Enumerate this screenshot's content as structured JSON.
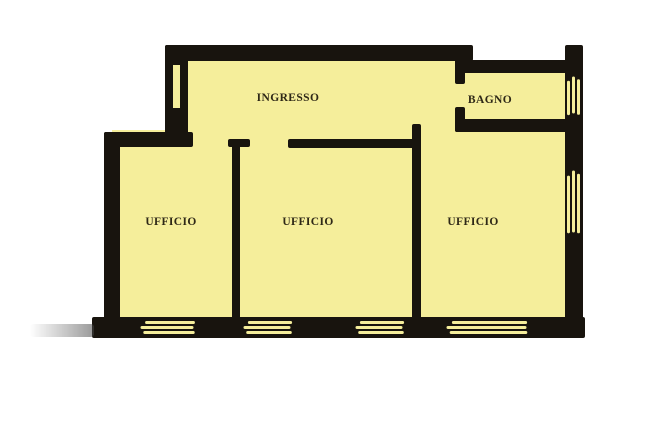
{
  "plan": {
    "rooms": [
      {
        "id": "ingresso",
        "label": "INGRESSO"
      },
      {
        "id": "bagno",
        "label": "BAGNO"
      },
      {
        "id": "ufficio-left",
        "label": "UFFICIO"
      },
      {
        "id": "ufficio-center",
        "label": "UFFICIO"
      },
      {
        "id": "ufficio-right",
        "label": "UFFICIO"
      }
    ],
    "colors": {
      "room_fill": "#f5ee9b",
      "wall": "#18140e",
      "label_text": "#2e2817",
      "background": "#ffffff"
    }
  }
}
